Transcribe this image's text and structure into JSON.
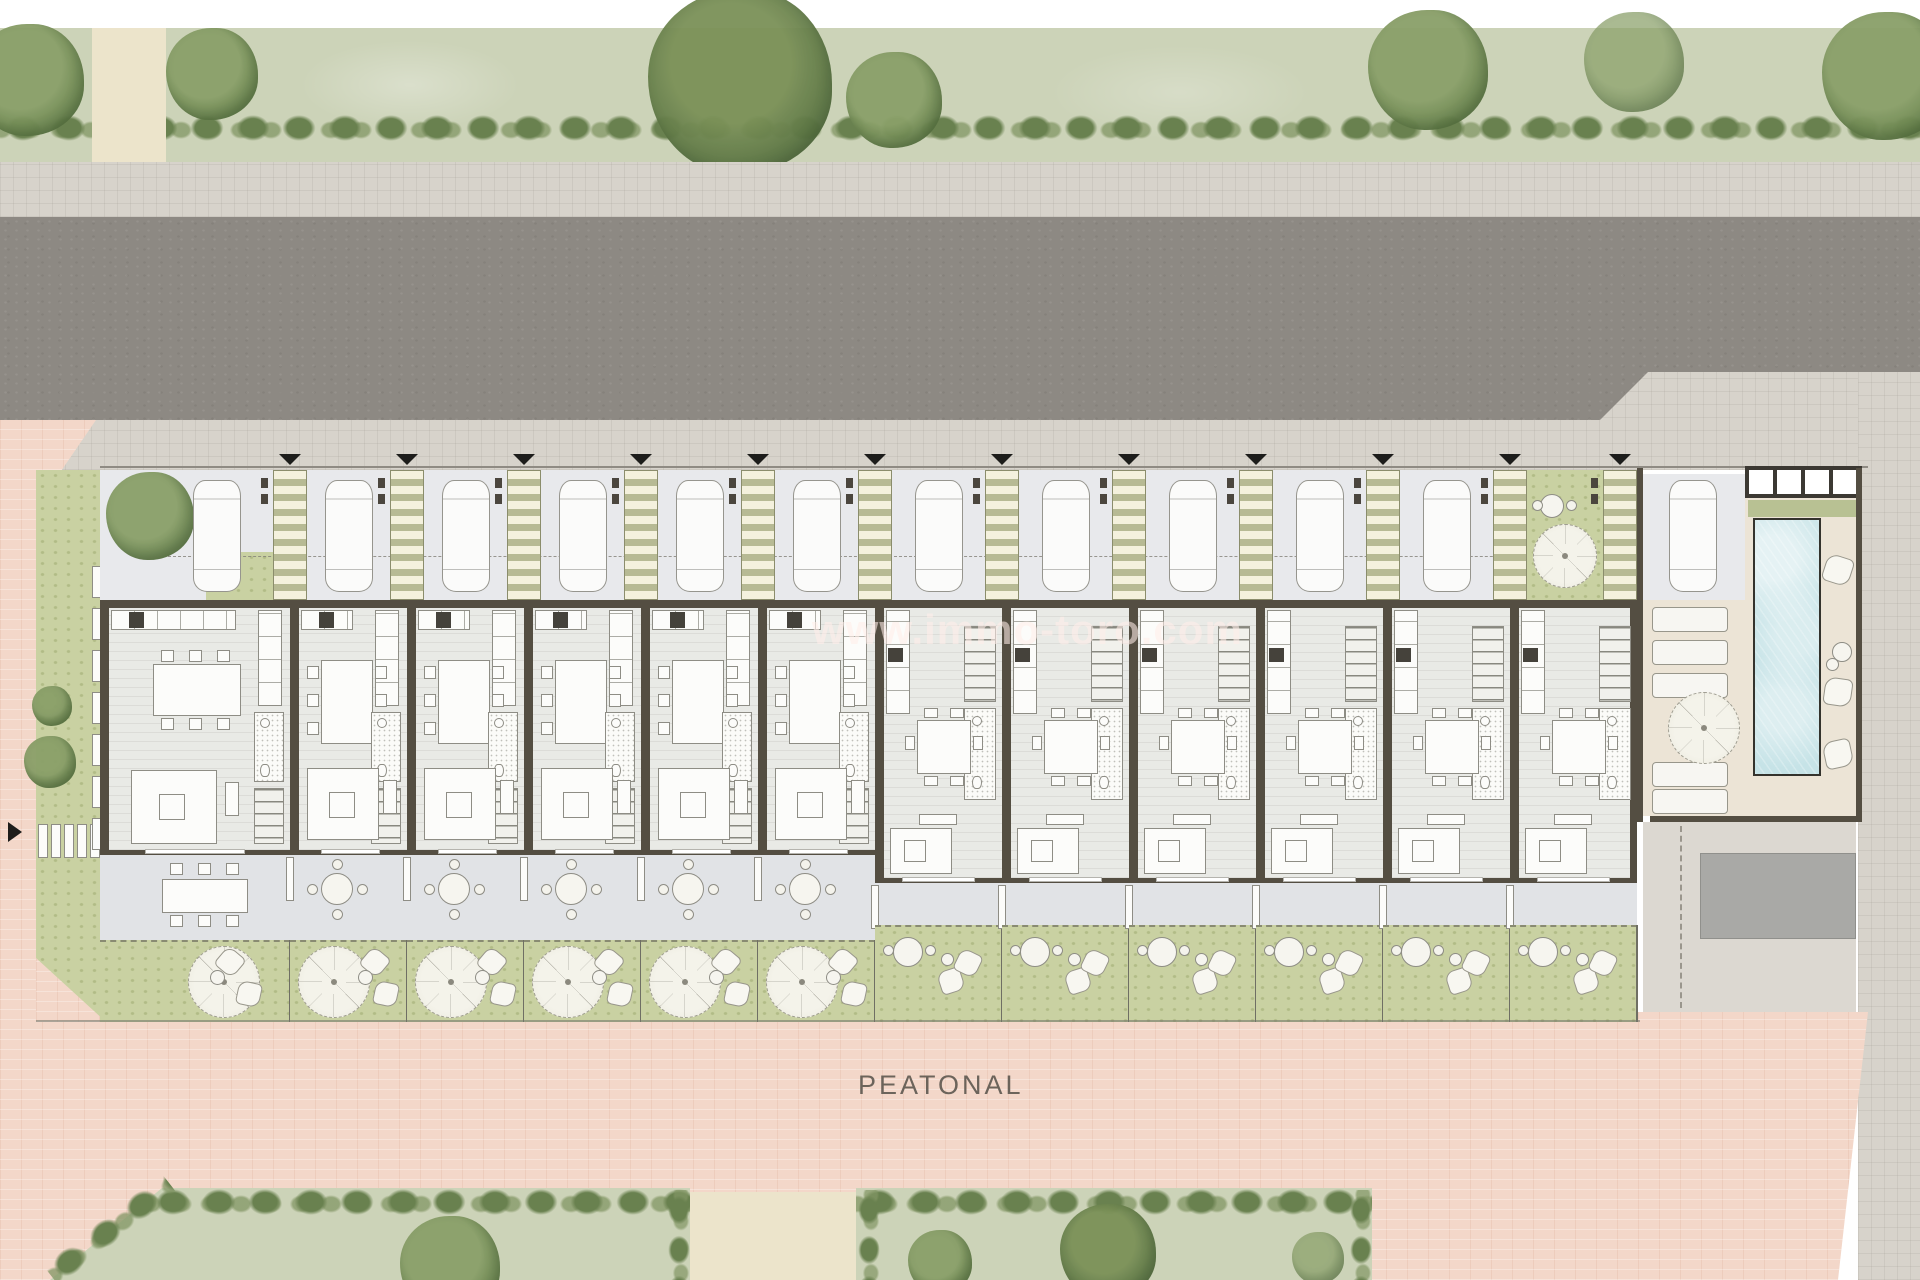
{
  "labels": {
    "street": "PEATONAL",
    "watermark": "www.immo-toro.com"
  },
  "colors": {
    "road": "#8d8983",
    "sidewalk": "#d7d3cb",
    "sidewalk_line": "#c5c1b8",
    "plaza": "#f3d7c9",
    "plaza_line": "#e7c0ae",
    "lawn": "#ccd3b8",
    "garden": "#c9d1a2",
    "garden_dot": "#aeba84",
    "hedge": "#69814f",
    "tree": "#8aa069",
    "tree_dark": "#5e7a45",
    "path": "#ece4cb",
    "parking": "#e8e9ec",
    "car": "#fbfbfa",
    "car_line": "#96958e",
    "pergola_bg": "#b7ba94",
    "pergola_slat": "#f4f1dd",
    "pergola_line": "#8b8d6c",
    "wall": "#544e42",
    "floor": "#e9eae6",
    "furn": "#fcfcfa",
    "furn_line": "#8e8d85",
    "terrace": "#e1e3e6",
    "fence": "#6f6f64",
    "deck": "#ece4d6",
    "pool": "#c6e3e7",
    "pool_edge": "#34332d",
    "platform": "#a9a9a6",
    "arrow": "#1d1d1b",
    "label_text": "#5e5850",
    "watermark_text": "rgba(255,238,233,0.58)"
  },
  "site": {
    "street_top": "asphalt road with sidewalks",
    "street_bottom": "pedestrian paved street",
    "units": [
      {
        "id": 1,
        "type": "A",
        "end_unit": true,
        "parking": "car",
        "garden": "parasol, cushions, side table",
        "terrace": "outdoor dining table"
      },
      {
        "id": 2,
        "type": "A",
        "parking": "car",
        "garden": "parasol, cushions, side table",
        "terrace": "round table"
      },
      {
        "id": 3,
        "type": "A",
        "parking": "car",
        "garden": "parasol, cushions, side table",
        "terrace": "round table"
      },
      {
        "id": 4,
        "type": "A",
        "parking": "car",
        "garden": "parasol, cushions, side table",
        "terrace": "round table"
      },
      {
        "id": 5,
        "type": "A",
        "parking": "car",
        "garden": "parasol, cushions, side table",
        "terrace": "round table"
      },
      {
        "id": 6,
        "type": "A",
        "parking": "car",
        "garden": "parasol, cushions, side table",
        "terrace": "round table"
      },
      {
        "id": 7,
        "type": "B",
        "parking": "car",
        "garden": "round table, cushions",
        "terrace": "narrow"
      },
      {
        "id": 8,
        "type": "B",
        "parking": "car",
        "garden": "round table, cushions",
        "terrace": "narrow"
      },
      {
        "id": 9,
        "type": "B",
        "parking": "car",
        "garden": "round table, cushions",
        "terrace": "narrow"
      },
      {
        "id": 10,
        "type": "B",
        "parking": "car",
        "garden": "round table, cushions",
        "terrace": "narrow"
      },
      {
        "id": 11,
        "type": "B",
        "parking": "car",
        "garden": "round table, cushions",
        "terrace": "narrow"
      },
      {
        "id": 12,
        "type": "B",
        "parking": "garden",
        "garden": "round table, cushions",
        "terrace": "narrow"
      }
    ],
    "parking_row": {
      "entrance_arrows": 12,
      "pergola_strips": 12,
      "cars": 12,
      "garden_bay": {
        "parasol": 1,
        "table": 1
      }
    },
    "pool_area": {
      "pool": 1,
      "loungers": 5,
      "cushions": 3,
      "side_tables": 2,
      "parasol": 1,
      "planter": 1,
      "pavilion_panels": 4,
      "guest_car": 1,
      "platform": 1
    }
  },
  "landscape": {
    "top_trees": [
      {
        "x": 28,
        "y": 80,
        "r": 56
      },
      {
        "x": 212,
        "y": 74,
        "r": 46
      },
      {
        "x": 740,
        "y": 82,
        "r": 92,
        "v": "dark"
      },
      {
        "x": 894,
        "y": 100,
        "r": 48
      },
      {
        "x": 1428,
        "y": 70,
        "r": 60
      },
      {
        "x": 1634,
        "y": 62,
        "r": 50,
        "v": "light"
      },
      {
        "x": 1886,
        "y": 76,
        "r": 64
      }
    ],
    "left_shrubs": [
      {
        "x": 52,
        "y": 706,
        "r": 20
      },
      {
        "x": 50,
        "y": 762,
        "r": 26
      },
      {
        "x": 150,
        "y": 516,
        "r": 44
      }
    ],
    "bottom_plots": [
      {
        "x": 50,
        "w": 640,
        "bevel": true,
        "trees": [
          {
            "x": 450,
            "y": 1266,
            "r": 50
          }
        ]
      },
      {
        "x": 856,
        "w": 516,
        "trees": [
          {
            "x": 940,
            "y": 1262,
            "r": 32
          },
          {
            "x": 1108,
            "y": 1252,
            "r": 48,
            "v": "dark"
          },
          {
            "x": 1318,
            "y": 1258,
            "r": 26,
            "v": "light"
          }
        ]
      }
    ],
    "bottom_paths": [
      {
        "x": 690,
        "w": 166
      }
    ],
    "top_path": {
      "x": 92,
      "w": 74
    }
  }
}
